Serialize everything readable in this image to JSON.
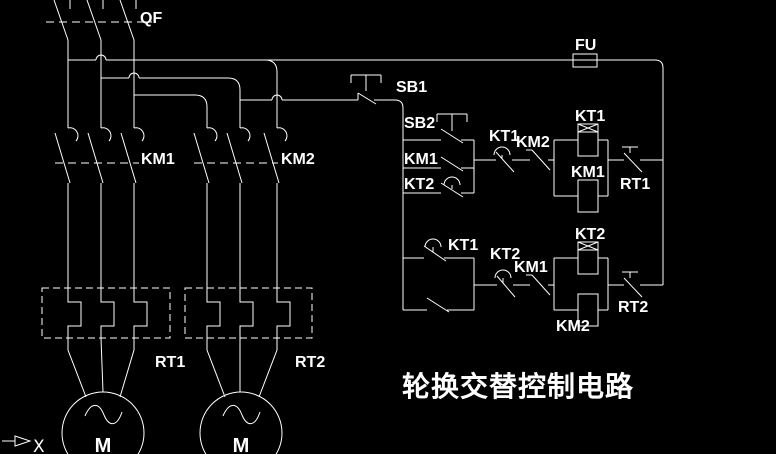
{
  "colors": {
    "background": "#000000",
    "line": "#ffffff"
  },
  "title": "轮换交替控制电路",
  "ucs": {
    "x_axis": "X"
  },
  "power": {
    "breaker": "QF",
    "contactor_main_1": "KM1",
    "contactor_main_2": "KM2",
    "thermal_relay_1": "RT1",
    "thermal_relay_2": "RT2",
    "motor_1": "M",
    "motor_2": "M"
  },
  "control": {
    "fuse": "FU",
    "stop_button": "SB1",
    "start_button": "SB2",
    "rung1": {
      "selfhold_contact": "KM1",
      "kt2_parallel_contact": "KT2",
      "kt1_delay_contact": "KT1",
      "km2_interlock_contact": "KM2",
      "kt1_coil": "KT1",
      "km1_coil": "KM1",
      "thermal_contact": "RT1"
    },
    "rung2": {
      "kt1_delay_contact": "KT1",
      "kt2_delay_contact": "KT2",
      "km1_interlock_contact": "KM1",
      "kt2_coil": "KT2",
      "km2_coil": "KM2",
      "thermal_contact": "RT2"
    }
  }
}
